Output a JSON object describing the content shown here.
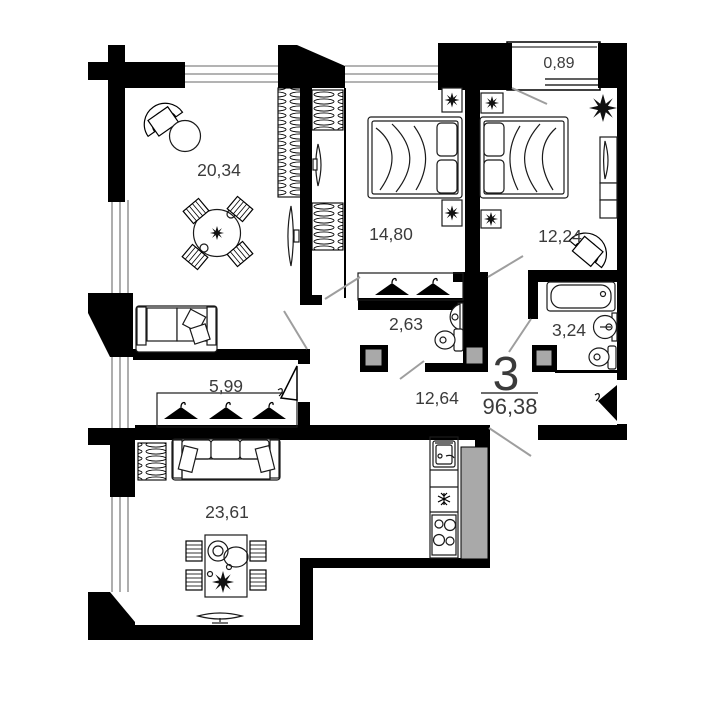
{
  "plan": {
    "unit_summary": {
      "rooms_count": "3",
      "total_area": "96,38"
    },
    "rooms": [
      {
        "name": "living-room",
        "area": "20,34"
      },
      {
        "name": "bedroom-1",
        "area": "14,80"
      },
      {
        "name": "bedroom-2",
        "area": "12,24"
      },
      {
        "name": "balcony",
        "area": "0,89"
      },
      {
        "name": "water-closet",
        "area": "2,63"
      },
      {
        "name": "bathroom",
        "area": "3,24"
      },
      {
        "name": "hall",
        "area": "5,99"
      },
      {
        "name": "corridor",
        "area": "12,64"
      },
      {
        "name": "kitchen-living",
        "area": "23,61"
      }
    ],
    "icons": {
      "plant": "plant-icon",
      "hanger": "hanger-icon",
      "bed": "bed-icon",
      "bathtub": "bathtub-icon",
      "toilet": "toilet-icon",
      "sink": "sink-icon",
      "stove": "stove-icon",
      "fridge": "fridge-snowflake-icon",
      "tv": "tv-icon",
      "sofa": "sofa-icon",
      "wardrobe": "wardrobe-icon",
      "door": "door-leaf-icon"
    },
    "colors": {
      "wall": "#000000",
      "window_line": "#9a9a9a",
      "shaft_fill": "#a9a9a9",
      "door_line": "#9e9e9e",
      "label_text": "#3b3b3b"
    }
  }
}
